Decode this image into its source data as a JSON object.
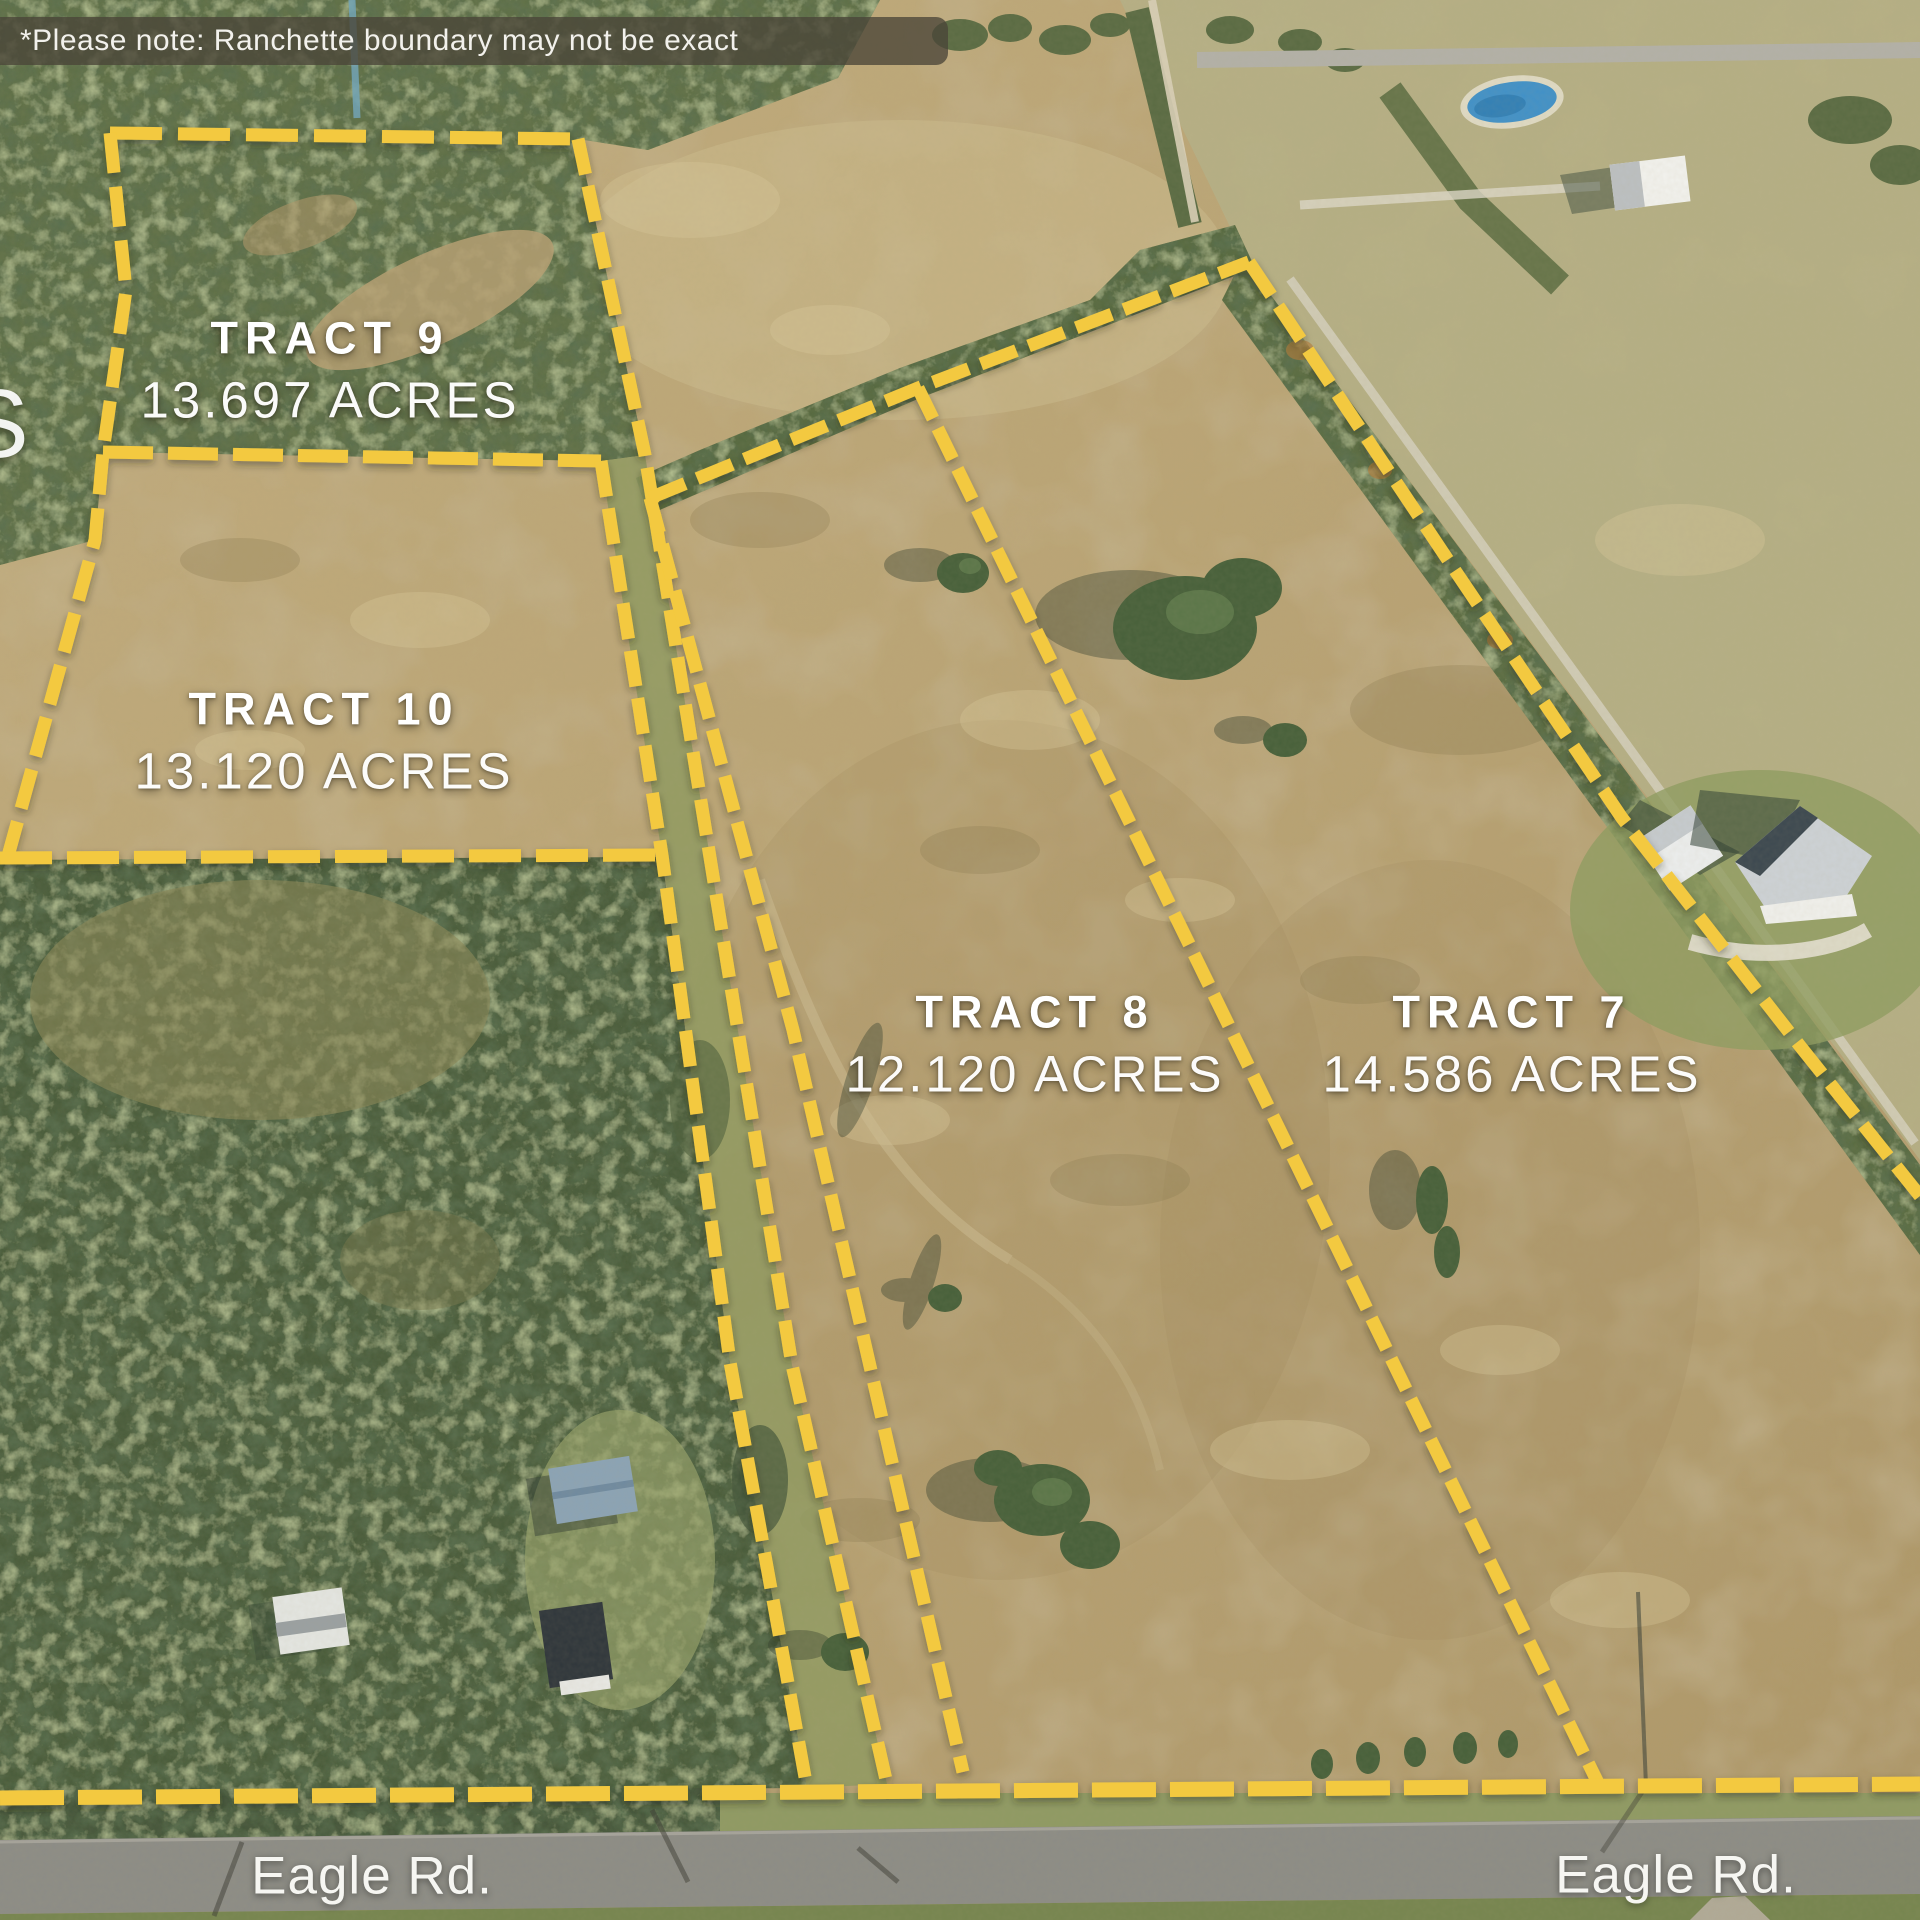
{
  "disclaimer": "*Please note: Ranchette boundary may not be exact",
  "edge_partial_text": "S",
  "tracts": [
    {
      "name": "TRACT 9",
      "acres": "13.697 ACRES"
    },
    {
      "name": "TRACT 10",
      "acres": "13.120 ACRES"
    },
    {
      "name": "TRACT 8",
      "acres": "12.120 ACRES"
    },
    {
      "name": "TRACT 7",
      "acres": "14.586 ACRES"
    }
  ],
  "road_labels": [
    {
      "text": "Eagle Rd."
    },
    {
      "text": "Eagle Rd."
    }
  ],
  "colors": {
    "boundary_yellow": "#F3C93F",
    "label_white": "#FFFFFF",
    "disclaimer_bg": "rgba(74,69,56,0.78)"
  }
}
